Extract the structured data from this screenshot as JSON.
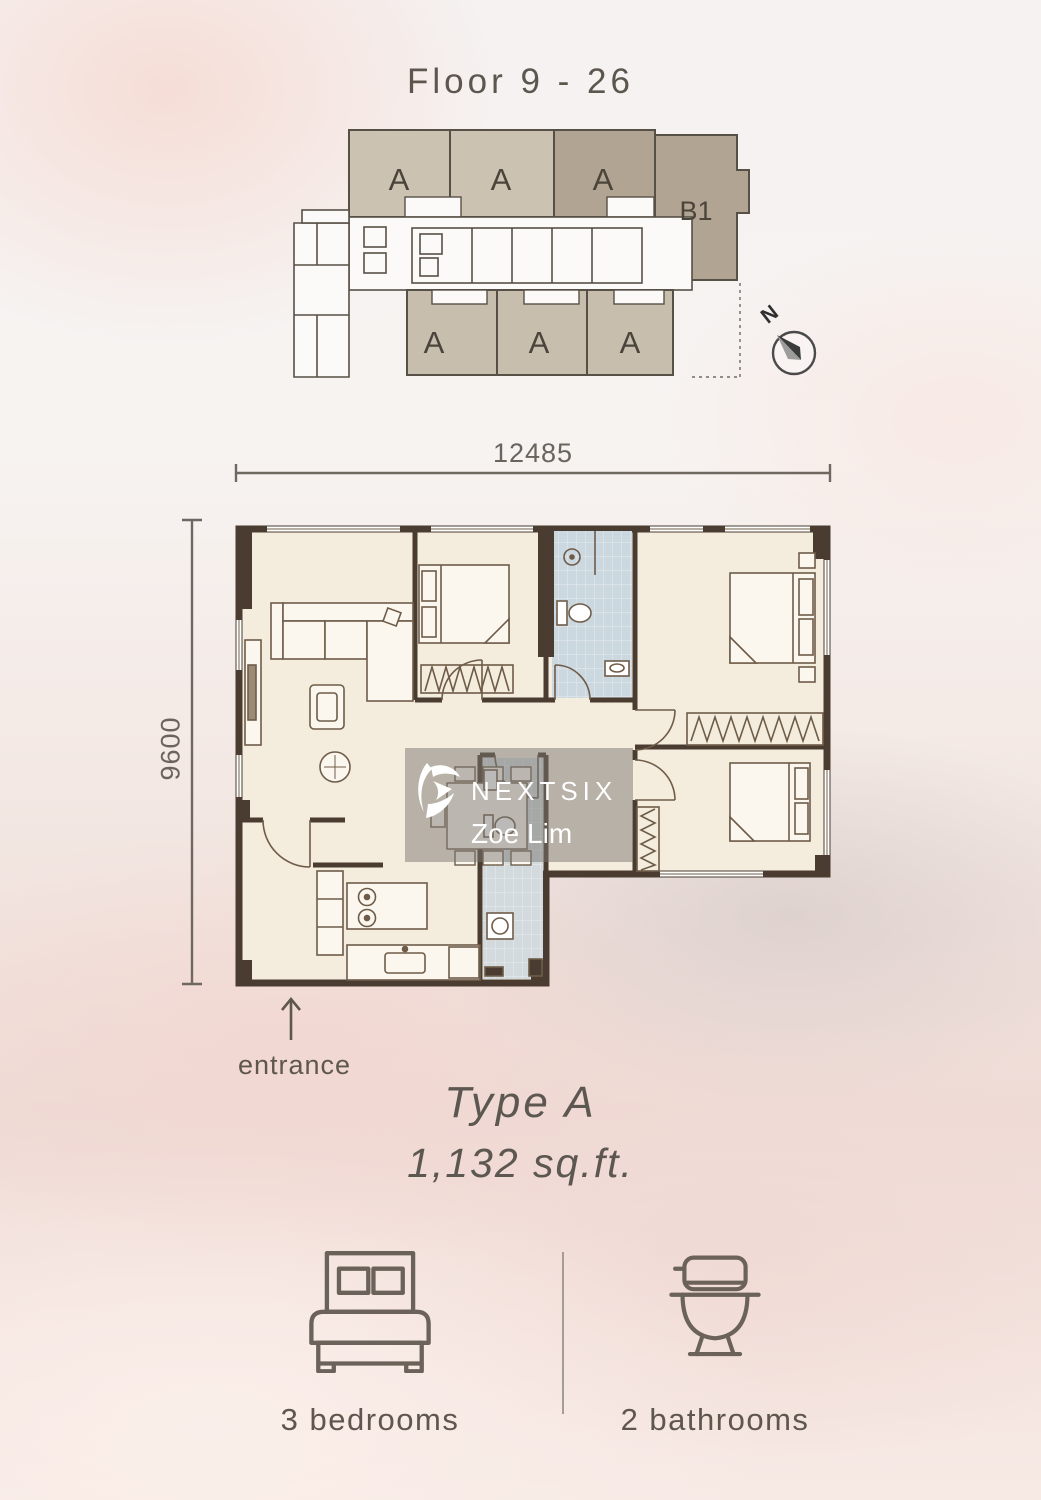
{
  "header": {
    "title": "Floor 9 - 26"
  },
  "keyplan": {
    "top_units": [
      "A",
      "A",
      "A"
    ],
    "corner_unit": "B1",
    "bottom_units": [
      "A",
      "A",
      "A"
    ],
    "north_label": "N"
  },
  "dimensions": {
    "width_label": "12485",
    "height_label": "9600"
  },
  "watermark": {
    "brand": "NEXTSIX",
    "agent": "Zoe Lim"
  },
  "plan": {
    "entrance_label": "entrance"
  },
  "unit_info": {
    "type": "Type A",
    "area": "1,132 sq.ft."
  },
  "features": [
    {
      "icon": "bed-icon",
      "label": "3 bedrooms"
    },
    {
      "icon": "toilet-icon",
      "label": "2 bathrooms"
    }
  ],
  "colors": {
    "wall": "#4a3c31",
    "floor": "#f4ecdc",
    "bathroom_tile": "#ccd8e0",
    "keyplan_unit_light": "#cbc2b1",
    "keyplan_unit_dark": "#b2a492",
    "text": "#5d564f",
    "background_pink": "#f2e5e0",
    "watermark_background": "rgba(122,118,113,0.5)"
  }
}
